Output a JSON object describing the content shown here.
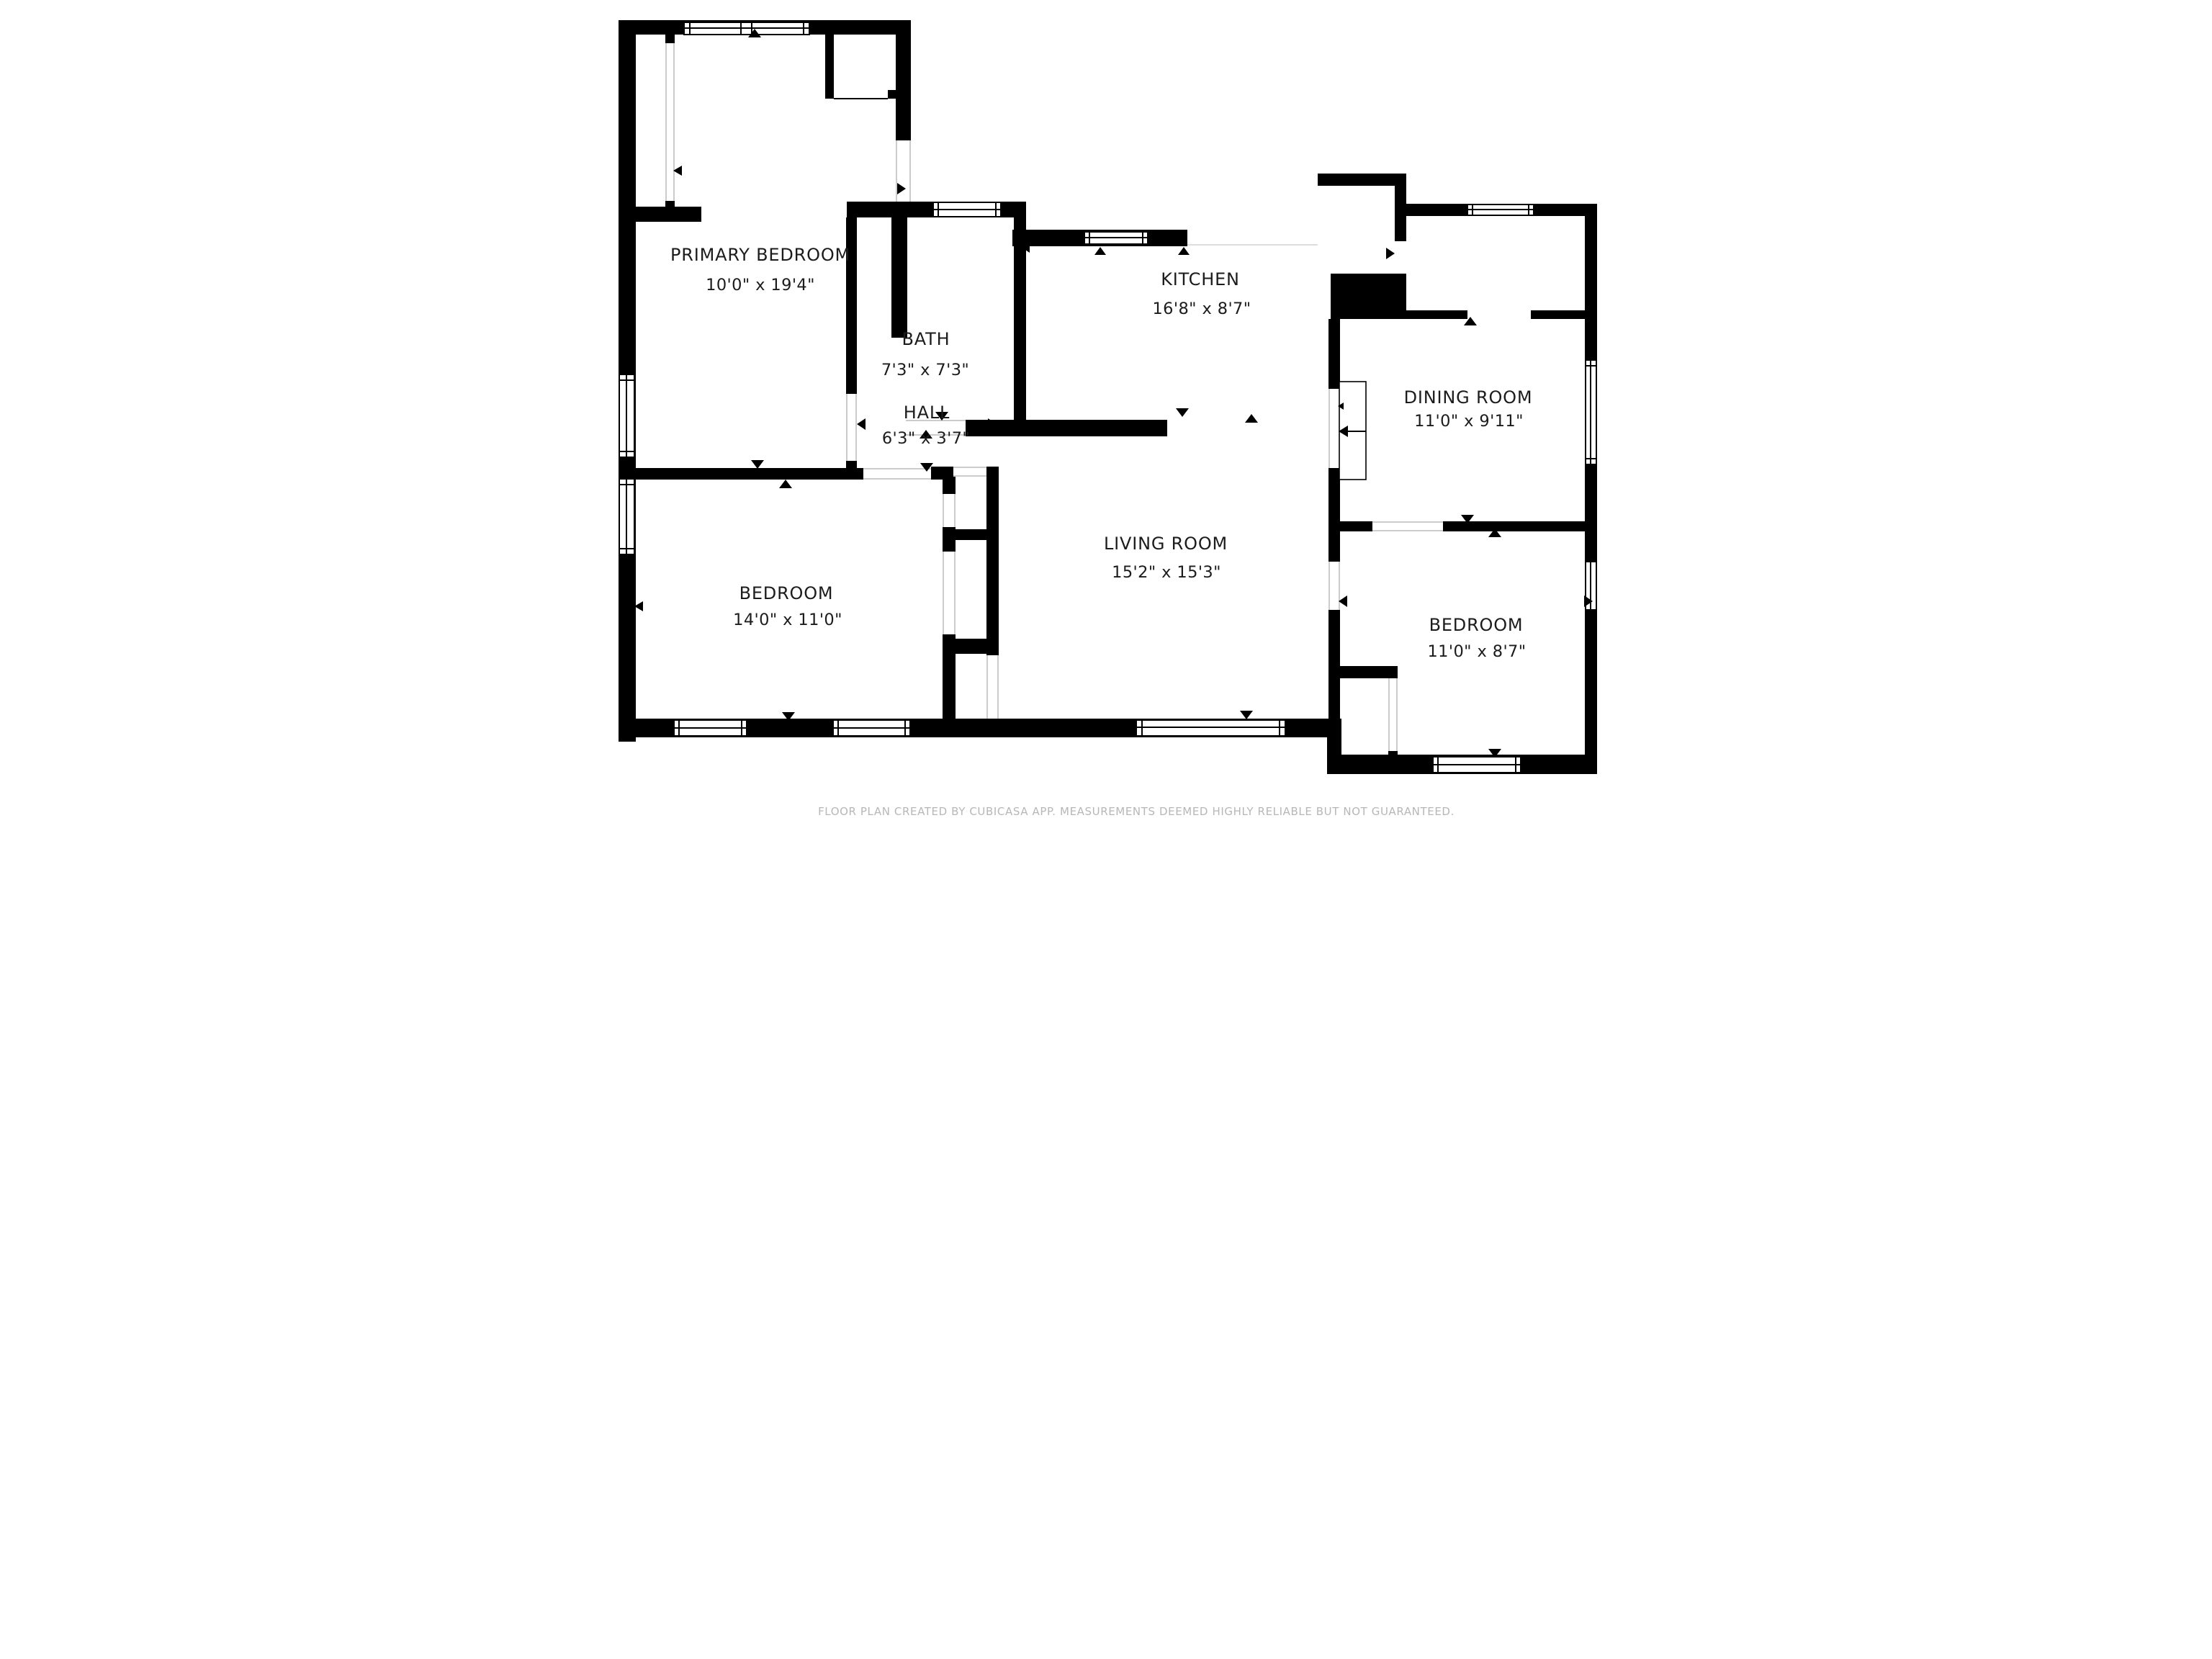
{
  "rooms": [
    {
      "name": "PRIMARY BEDROOM",
      "dims": "10'0\" x 19'4\""
    },
    {
      "name": "BATH",
      "dims": "7'3\" x 7'3\""
    },
    {
      "name": "KITCHEN",
      "dims": "16'8\" x 8'7\""
    },
    {
      "name": "HALL",
      "dims": "6'3\" x 3'7\""
    },
    {
      "name": "DINING ROOM",
      "dims": "11'0\" x 9'11\""
    },
    {
      "name": "LIVING ROOM",
      "dims": "15'2\" x 15'3\""
    },
    {
      "name": "BEDROOM",
      "dims": "14'0\" x 11'0\""
    },
    {
      "name": "BEDROOM",
      "dims": "11'0\" x 8'7\""
    }
  ],
  "footer": {
    "disclaimer": "FLOOR PLAN CREATED BY CUBICASA APP. MEASUREMENTS DEEMED HIGHLY RELIABLE BUT NOT GUARANTEED."
  },
  "colors": {
    "wall": "#000000",
    "background": "#ffffff",
    "label": "#1c1c1c",
    "muted": "#b7b7b7"
  }
}
